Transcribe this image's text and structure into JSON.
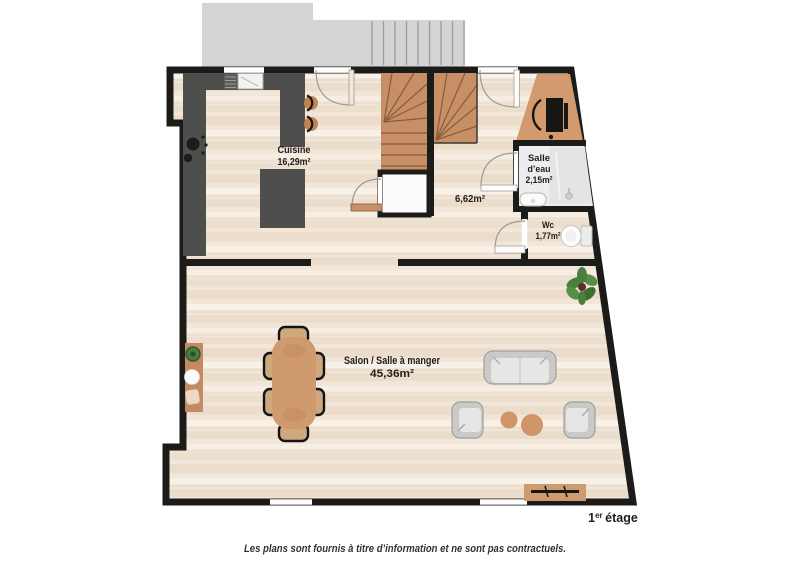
{
  "plan": {
    "floor_label": {
      "number": "1",
      "suffix": "er",
      "rest": "étage"
    },
    "rooms": {
      "cuisine": {
        "name": "Cuisine",
        "area": "16,29m²"
      },
      "hall": {
        "area": "6,62m²"
      },
      "salle_eau": {
        "name_line_1": "Salle",
        "name_line_2": "d’eau",
        "area": "2,15m²"
      },
      "wc": {
        "name": "Wc",
        "area": "1,77m²"
      },
      "salon": {
        "name": "Salon / Salle à manger",
        "area": "45,36m²"
      }
    },
    "colors": {
      "wall": "#1b1b1a",
      "floor_wood": "#f1e6d8",
      "floor_tile": "#ededef",
      "terrace_gray": "#d4d4d4",
      "stairs_wood": "#c68f66",
      "furniture_wood": "#d09a6f",
      "kitchen_counter": "#4e4e4d",
      "sofa_gray": "#c9c9c7",
      "plant_green": "#4c7f3d",
      "text": "#1e1e1c"
    }
  },
  "footer": {
    "text": "Les plans sont fournis à titre d’information et ne sont pas contractuels."
  }
}
